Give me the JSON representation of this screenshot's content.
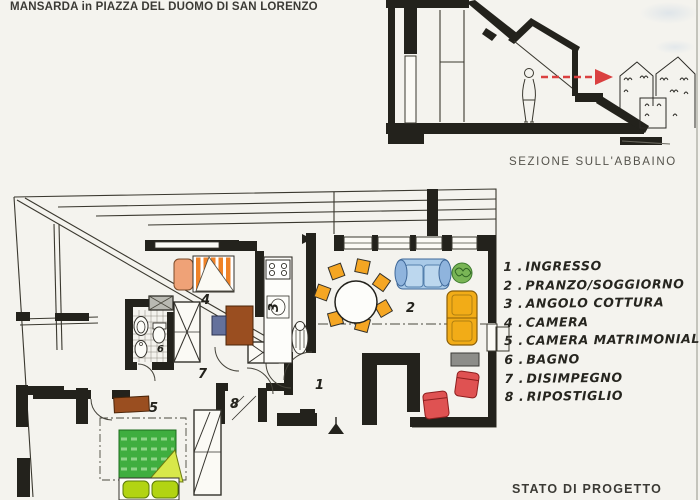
{
  "title": "MANSARDA in PIAZZA DEL DUOMO DI SAN LORENZO",
  "section": {
    "caption": "SEZIONE SULL'ABBAINO"
  },
  "plan": {
    "room_numbers": [
      "1",
      "2",
      "3",
      "4",
      "5",
      "6",
      "7",
      "8"
    ]
  },
  "legend": {
    "items": [
      {
        "num": "1 .",
        "label": "INGRESSO"
      },
      {
        "num": "2 .",
        "label": "PRANZO/SOGGIORNO"
      },
      {
        "num": "3 .",
        "label": "ANGOLO COTTURA"
      },
      {
        "num": "4 .",
        "label": "CAMERA"
      },
      {
        "num": "5 .",
        "label": "CAMERA MATRIMONIALE"
      },
      {
        "num": "6 .",
        "label": "BAGNO"
      },
      {
        "num": "7 .",
        "label": "DISIMPEGNO"
      },
      {
        "num": "8 .",
        "label": "RIPOSTIGLIO"
      }
    ]
  },
  "footer": {
    "status_label": "STATO DI PROGETTO"
  },
  "colors": {
    "ink": "#23221c",
    "paper": "#f4f3ee",
    "red_arrow": "#da4040",
    "bed_orange": "#ef8227",
    "headboard_salmon": "#efa277",
    "bed_green": "#3fae3f",
    "pillow_green": "#b2d412",
    "sofa_blue": "#a9cae8",
    "armchair_yellow": "#f2ac17",
    "chair_orange": "#f5a623",
    "armchair_red": "#df5252",
    "wood_brown": "#9a4e20",
    "plant_green": "#79b556"
  }
}
